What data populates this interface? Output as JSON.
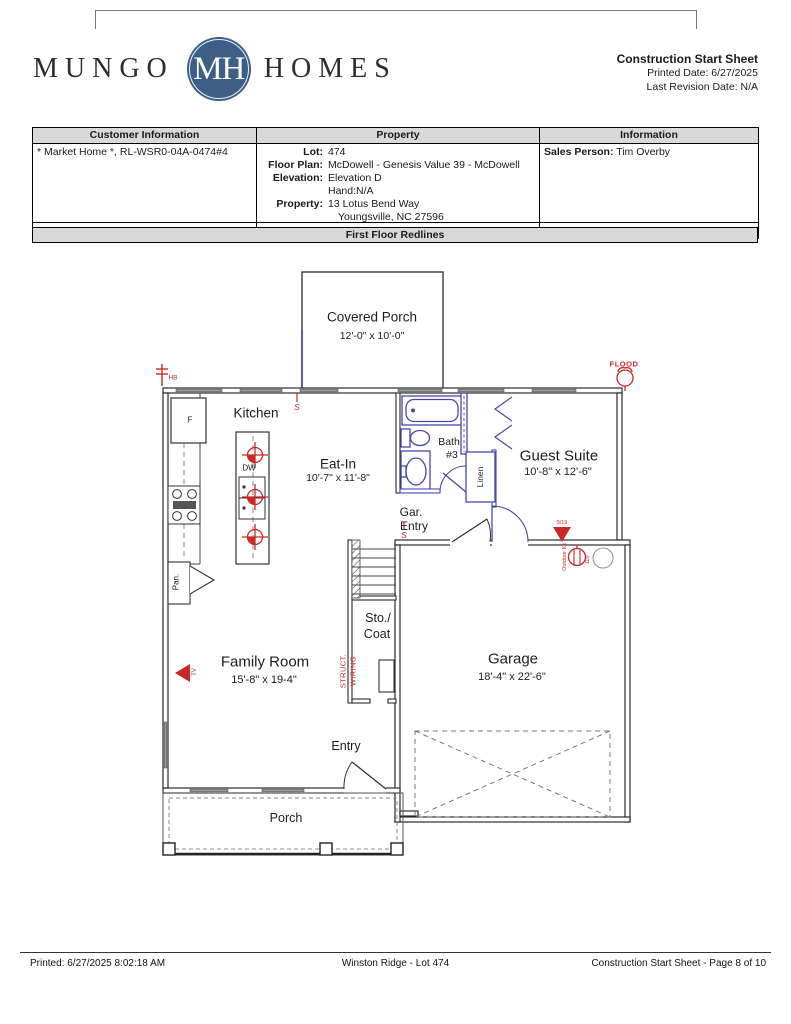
{
  "page": {
    "header": {
      "logo_word1": "MUNGO",
      "logo_circle": "MH",
      "logo_word2": "HOMES",
      "title": "Construction Start Sheet",
      "printed_date": "Printed Date: 6/27/2025",
      "last_revision": "Last Revision Date: N/A"
    },
    "info_table": {
      "col_customer": "Customer Information",
      "col_property": "Property",
      "col_information": "Information",
      "customer_value": "* Market Home *, RL-WSR0-04A-0474#4",
      "property": {
        "lot_label": "Lot:",
        "lot_value": "474",
        "floor_plan_label": "Floor Plan:",
        "floor_plan_value": "McDowell - Genesis Value 39 - McDowell",
        "elevation_label": "Elevation:",
        "elevation_value": "Elevation D",
        "hand_value": "Hand:N/A",
        "property_label": "Property:",
        "address_line1": "13 Lotus Bend Way",
        "address_line2": "Youngsville, NC 27596"
      },
      "sales_label": "Sales Person:",
      "sales_value": "Tim Overby"
    },
    "section_title": "First Floor Redlines",
    "footer": {
      "left": "Printed: 6/27/2025 8:02:18 AM",
      "center": "Winston Ridge - Lot 474",
      "right": "Construction Start Sheet - Page 8 of 10"
    }
  },
  "floor_plan": {
    "labels": {
      "covered_porch_name": "Covered Porch",
      "covered_porch_dims": "12'-0\" x 10'-0\"",
      "kitchen": "Kitchen",
      "eat_in_name": "Eat-In",
      "eat_in_dims": "10'-7\" x 11'-8\"",
      "bath_line1": "Bath",
      "bath_line2": "#3",
      "linen": "Linen",
      "guest_suite_name": "Guest Suite",
      "guest_suite_dims": "10'-8\" x 12'-6\"",
      "gar_entry_line1": "Gar.",
      "gar_entry_line2": "Entry",
      "sto_coat_line1": "Sto./",
      "sto_coat_line2": "Coat",
      "family_room_name": "Family Room",
      "family_room_dims": "15'-8\" x 19-4\"",
      "garage_name": "Garage",
      "garage_dims": "18'-4\" x 22'-6\"",
      "entry": "Entry",
      "porch": "Porch",
      "fridge": "F",
      "dishwasher": "DW",
      "pantry": "Pan."
    },
    "redlines": {
      "hb": "HB",
      "flood": "FLOOD",
      "keynote": "9/19",
      "outdoor_line1": "Outdoor Kit",
      "outdoor_line2": "110",
      "struct_line1": "STRUCT.",
      "struct_line2": "WIRING",
      "tv": "TV",
      "switch1": "S",
      "switch2": "S"
    },
    "colors": {
      "redline_red": "#c82a28",
      "redline_blue": "#4848ab",
      "wall": "#2b2b2b",
      "logo_blue": "#3d5f85"
    }
  }
}
